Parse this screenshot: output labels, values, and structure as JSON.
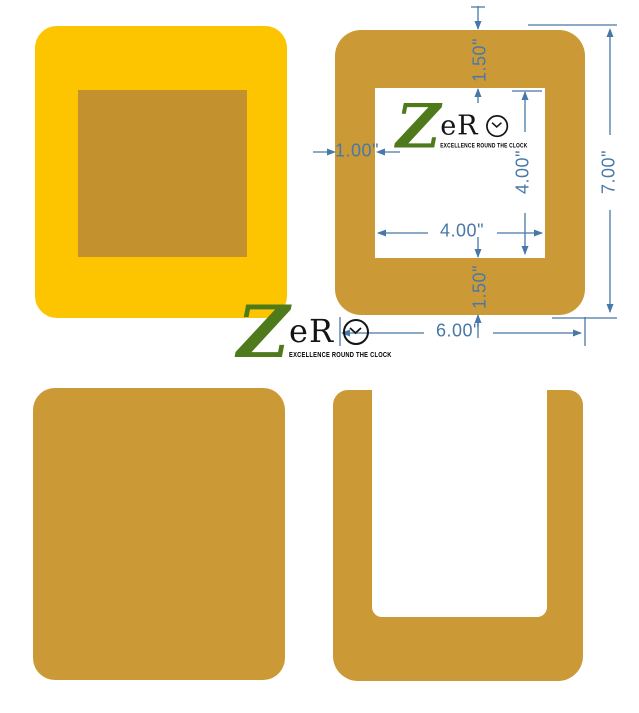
{
  "brand": {
    "z": "Z",
    "er": "eR",
    "o": "O",
    "tagline": "EXCELLENCE ROUND THE CLOCK"
  },
  "dimensions": {
    "top_border": "1.50\"",
    "left_border": "1.00\"",
    "inner_height": "4.00\"",
    "inner_width": "4.00\"",
    "bottom_border": "1.50\"",
    "outer_width": "6.00\"",
    "outer_height": "7.00\""
  },
  "colors": {
    "yellow": "#FDC500",
    "tan": "#CB9A37",
    "inner_tan": "#C3922E",
    "dimension_blue": "#4878A8",
    "logo_green": "#4E7A1C",
    "logo_black": "#141414"
  }
}
